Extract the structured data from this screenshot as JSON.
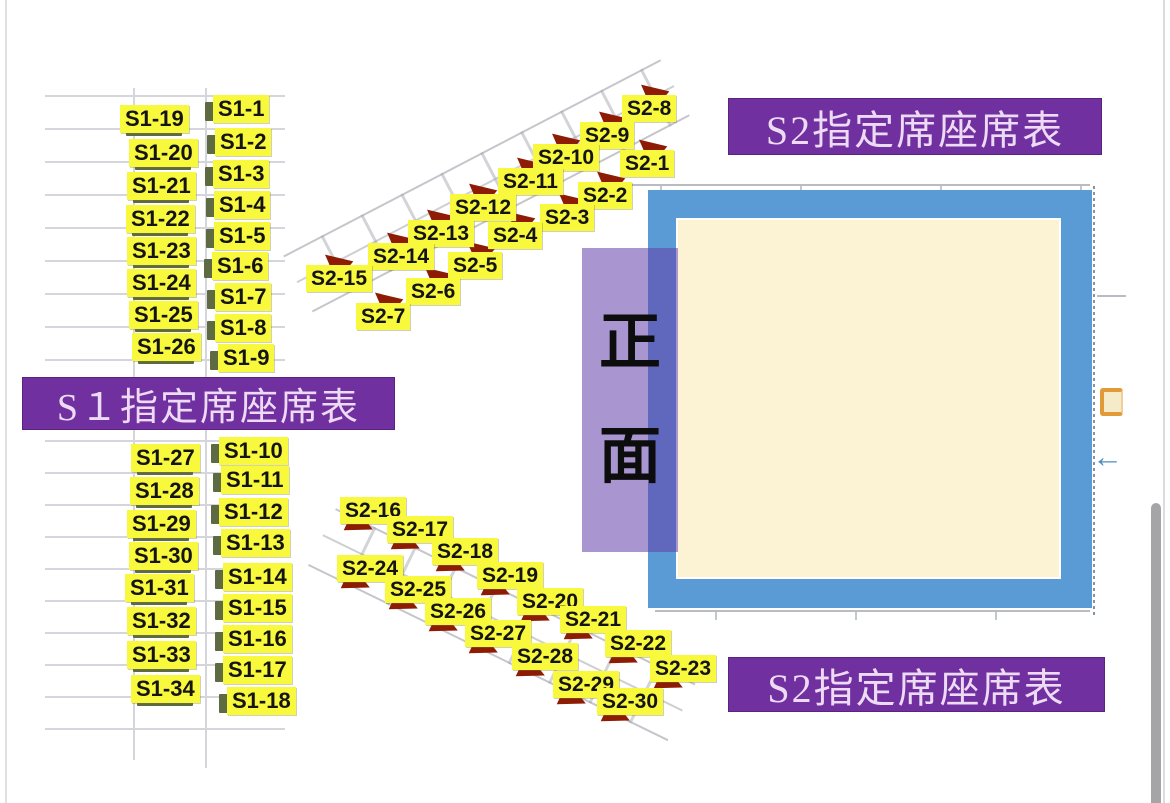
{
  "banners": {
    "s1": "S１指定席座席表",
    "s2_top": "S2指定席座席表",
    "s2_bottom": "S2指定席座席表"
  },
  "stage": {
    "front_label_char1": "正",
    "front_label_char2": "面"
  },
  "seats": {
    "s1_upper_left": [
      {
        "label": "S1-19",
        "x": 120,
        "y": 105
      },
      {
        "label": "S1-20",
        "x": 129,
        "y": 139
      },
      {
        "label": "S1-21",
        "x": 127,
        "y": 172
      },
      {
        "label": "S1-22",
        "x": 126,
        "y": 205
      },
      {
        "label": "S1-23",
        "x": 127,
        "y": 237
      },
      {
        "label": "S1-24",
        "x": 127,
        "y": 269
      },
      {
        "label": "S1-25",
        "x": 129,
        "y": 301
      },
      {
        "label": "S1-26",
        "x": 132,
        "y": 333
      }
    ],
    "s1_upper_right": [
      {
        "label": "S1-1",
        "x": 213,
        "y": 95
      },
      {
        "label": "S1-2",
        "x": 215,
        "y": 128
      },
      {
        "label": "S1-3",
        "x": 213,
        "y": 160
      },
      {
        "label": "S1-4",
        "x": 214,
        "y": 191
      },
      {
        "label": "S1-5",
        "x": 214,
        "y": 222
      },
      {
        "label": "S1-6",
        "x": 212,
        "y": 252
      },
      {
        "label": "S1-7",
        "x": 215,
        "y": 283
      },
      {
        "label": "S1-8",
        "x": 215,
        "y": 314
      },
      {
        "label": "S1-9",
        "x": 218,
        "y": 344
      }
    ],
    "s1_lower_left": [
      {
        "label": "S1-27",
        "x": 131,
        "y": 444
      },
      {
        "label": "S1-28",
        "x": 130,
        "y": 477
      },
      {
        "label": "S1-29",
        "x": 127,
        "y": 510
      },
      {
        "label": "S1-30",
        "x": 129,
        "y": 542
      },
      {
        "label": "S1-31",
        "x": 125,
        "y": 574
      },
      {
        "label": "S1-32",
        "x": 127,
        "y": 607
      },
      {
        "label": "S1-33",
        "x": 127,
        "y": 641
      },
      {
        "label": "S1-34",
        "x": 131,
        "y": 675
      }
    ],
    "s1_lower_right": [
      {
        "label": "S1-10",
        "x": 219,
        "y": 437
      },
      {
        "label": "S1-11",
        "x": 221,
        "y": 466
      },
      {
        "label": "S1-12",
        "x": 219,
        "y": 498
      },
      {
        "label": "S1-13",
        "x": 221,
        "y": 529
      },
      {
        "label": "S1-14",
        "x": 223,
        "y": 563
      },
      {
        "label": "S1-15",
        "x": 223,
        "y": 594
      },
      {
        "label": "S1-16",
        "x": 223,
        "y": 625
      },
      {
        "label": "S1-17",
        "x": 223,
        "y": 656
      },
      {
        "label": "S1-18",
        "x": 227,
        "y": 687
      }
    ],
    "s2_upper": [
      {
        "label": "S2-8",
        "x": 622,
        "y": 95
      },
      {
        "label": "S2-9",
        "x": 580,
        "y": 122
      },
      {
        "label": "S2-10",
        "x": 533,
        "y": 144
      },
      {
        "label": "S2-1",
        "x": 620,
        "y": 150
      },
      {
        "label": "S2-11",
        "x": 498,
        "y": 168
      },
      {
        "label": "S2-2",
        "x": 578,
        "y": 182
      },
      {
        "label": "S2-12",
        "x": 450,
        "y": 194
      },
      {
        "label": "S2-3",
        "x": 540,
        "y": 204
      },
      {
        "label": "S2-13",
        "x": 408,
        "y": 220
      },
      {
        "label": "S2-4",
        "x": 488,
        "y": 222
      },
      {
        "label": "S2-14",
        "x": 368,
        "y": 243
      },
      {
        "label": "S2-5",
        "x": 448,
        "y": 252
      },
      {
        "label": "S2-15",
        "x": 306,
        "y": 265
      },
      {
        "label": "S2-6",
        "x": 406,
        "y": 278
      },
      {
        "label": "S2-7",
        "x": 356,
        "y": 303
      }
    ],
    "s2_lower": [
      {
        "label": "S2-16",
        "x": 340,
        "y": 497
      },
      {
        "label": "S2-17",
        "x": 387,
        "y": 516
      },
      {
        "label": "S2-18",
        "x": 432,
        "y": 538
      },
      {
        "label": "S2-24",
        "x": 337,
        "y": 555
      },
      {
        "label": "S2-19",
        "x": 477,
        "y": 562
      },
      {
        "label": "S2-25",
        "x": 385,
        "y": 576
      },
      {
        "label": "S2-20",
        "x": 517,
        "y": 588
      },
      {
        "label": "S2-26",
        "x": 425,
        "y": 598
      },
      {
        "label": "S2-21",
        "x": 560,
        "y": 606
      },
      {
        "label": "S2-27",
        "x": 465,
        "y": 620
      },
      {
        "label": "S2-22",
        "x": 605,
        "y": 630
      },
      {
        "label": "S2-28",
        "x": 512,
        "y": 643
      },
      {
        "label": "S2-23",
        "x": 650,
        "y": 655
      },
      {
        "label": "S2-29",
        "x": 553,
        "y": 671
      },
      {
        "label": "S2-30",
        "x": 597,
        "y": 688
      }
    ]
  },
  "colors": {
    "highlight": "#f8f83c",
    "banner": "#7030a0",
    "banner_text": "#eddaf4",
    "stage_border": "#5b9bd5",
    "stage_fill": "#fcf2d4",
    "front_overlay": "rgba(98,62,168,0.55)",
    "seat_marker": "#8e1c05",
    "tab_olive": "#5e6b42",
    "door_icon": "#e29a38",
    "arrow_icon": "#4e8fc0"
  }
}
